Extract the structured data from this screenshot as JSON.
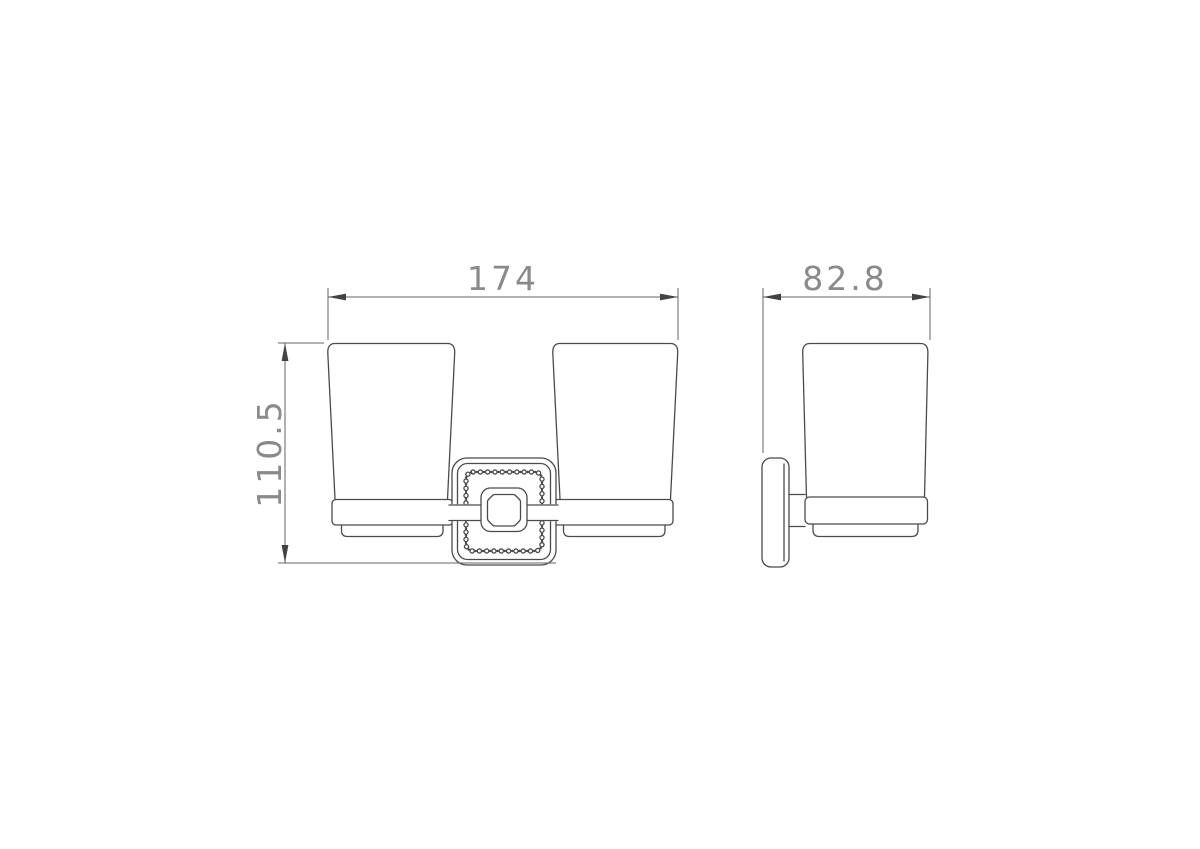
{
  "dimensions": {
    "front_width_label": "174",
    "side_depth_label": "82.8",
    "height_label": "110.5"
  },
  "colors": {
    "background": "#ffffff",
    "object_line": "#4a4a4a",
    "dimension_line": "#666666",
    "dimension_text": "#8a8a8a"
  }
}
